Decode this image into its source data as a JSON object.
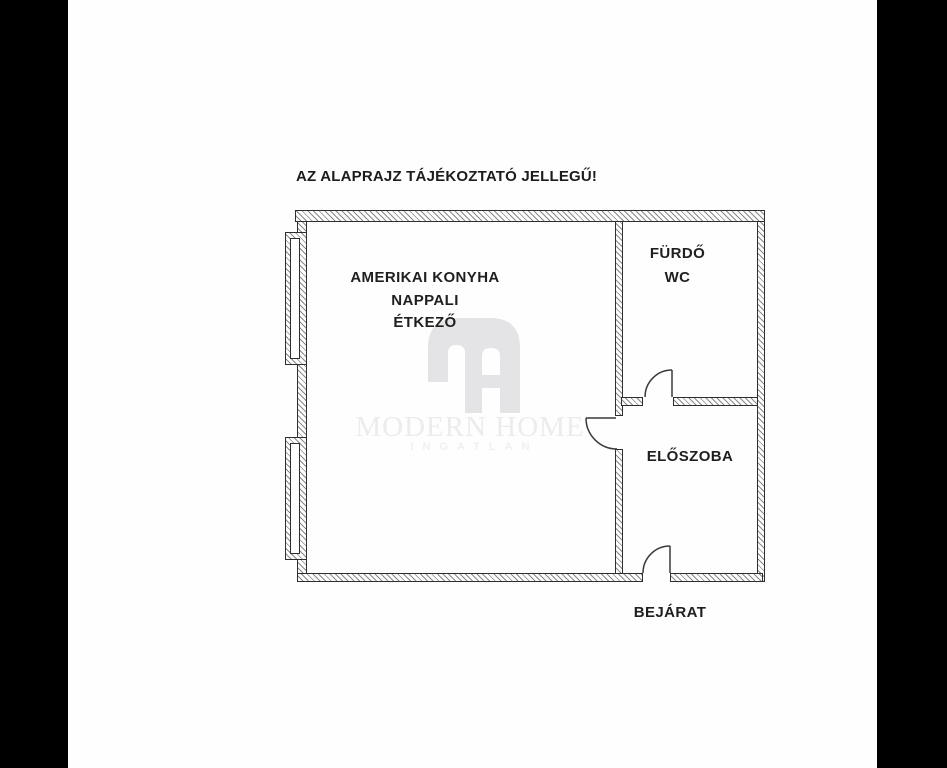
{
  "disclaimer": "AZ ALAPRAJZ TÁJÉKOZTATÓ JELLEGŰ!",
  "rooms": {
    "living": {
      "lines": [
        "AMERIKAI KONYHA",
        "NAPPALI",
        "ÉTKEZŐ"
      ]
    },
    "bathroom": {
      "lines": [
        "FÜRDŐ",
        "WC"
      ]
    },
    "hall": {
      "lines": [
        "ELŐSZOBA"
      ]
    }
  },
  "entrance_label": "BEJÁRAT",
  "watermark": {
    "brand": "MODERN HOME",
    "sub": "INGATLAN",
    "logo_icon": "modern-home-monogram"
  },
  "features": {
    "window_count": 2,
    "door_count": 3
  },
  "colors": {
    "background_bars": "#000000",
    "canvas": "#fefefe",
    "wall_line": "#2e2e2e",
    "hatch": "#8a8a8a",
    "text": "#1f1f1f",
    "watermark_logo": "#e4e4e6",
    "watermark_text": "#ececee"
  }
}
